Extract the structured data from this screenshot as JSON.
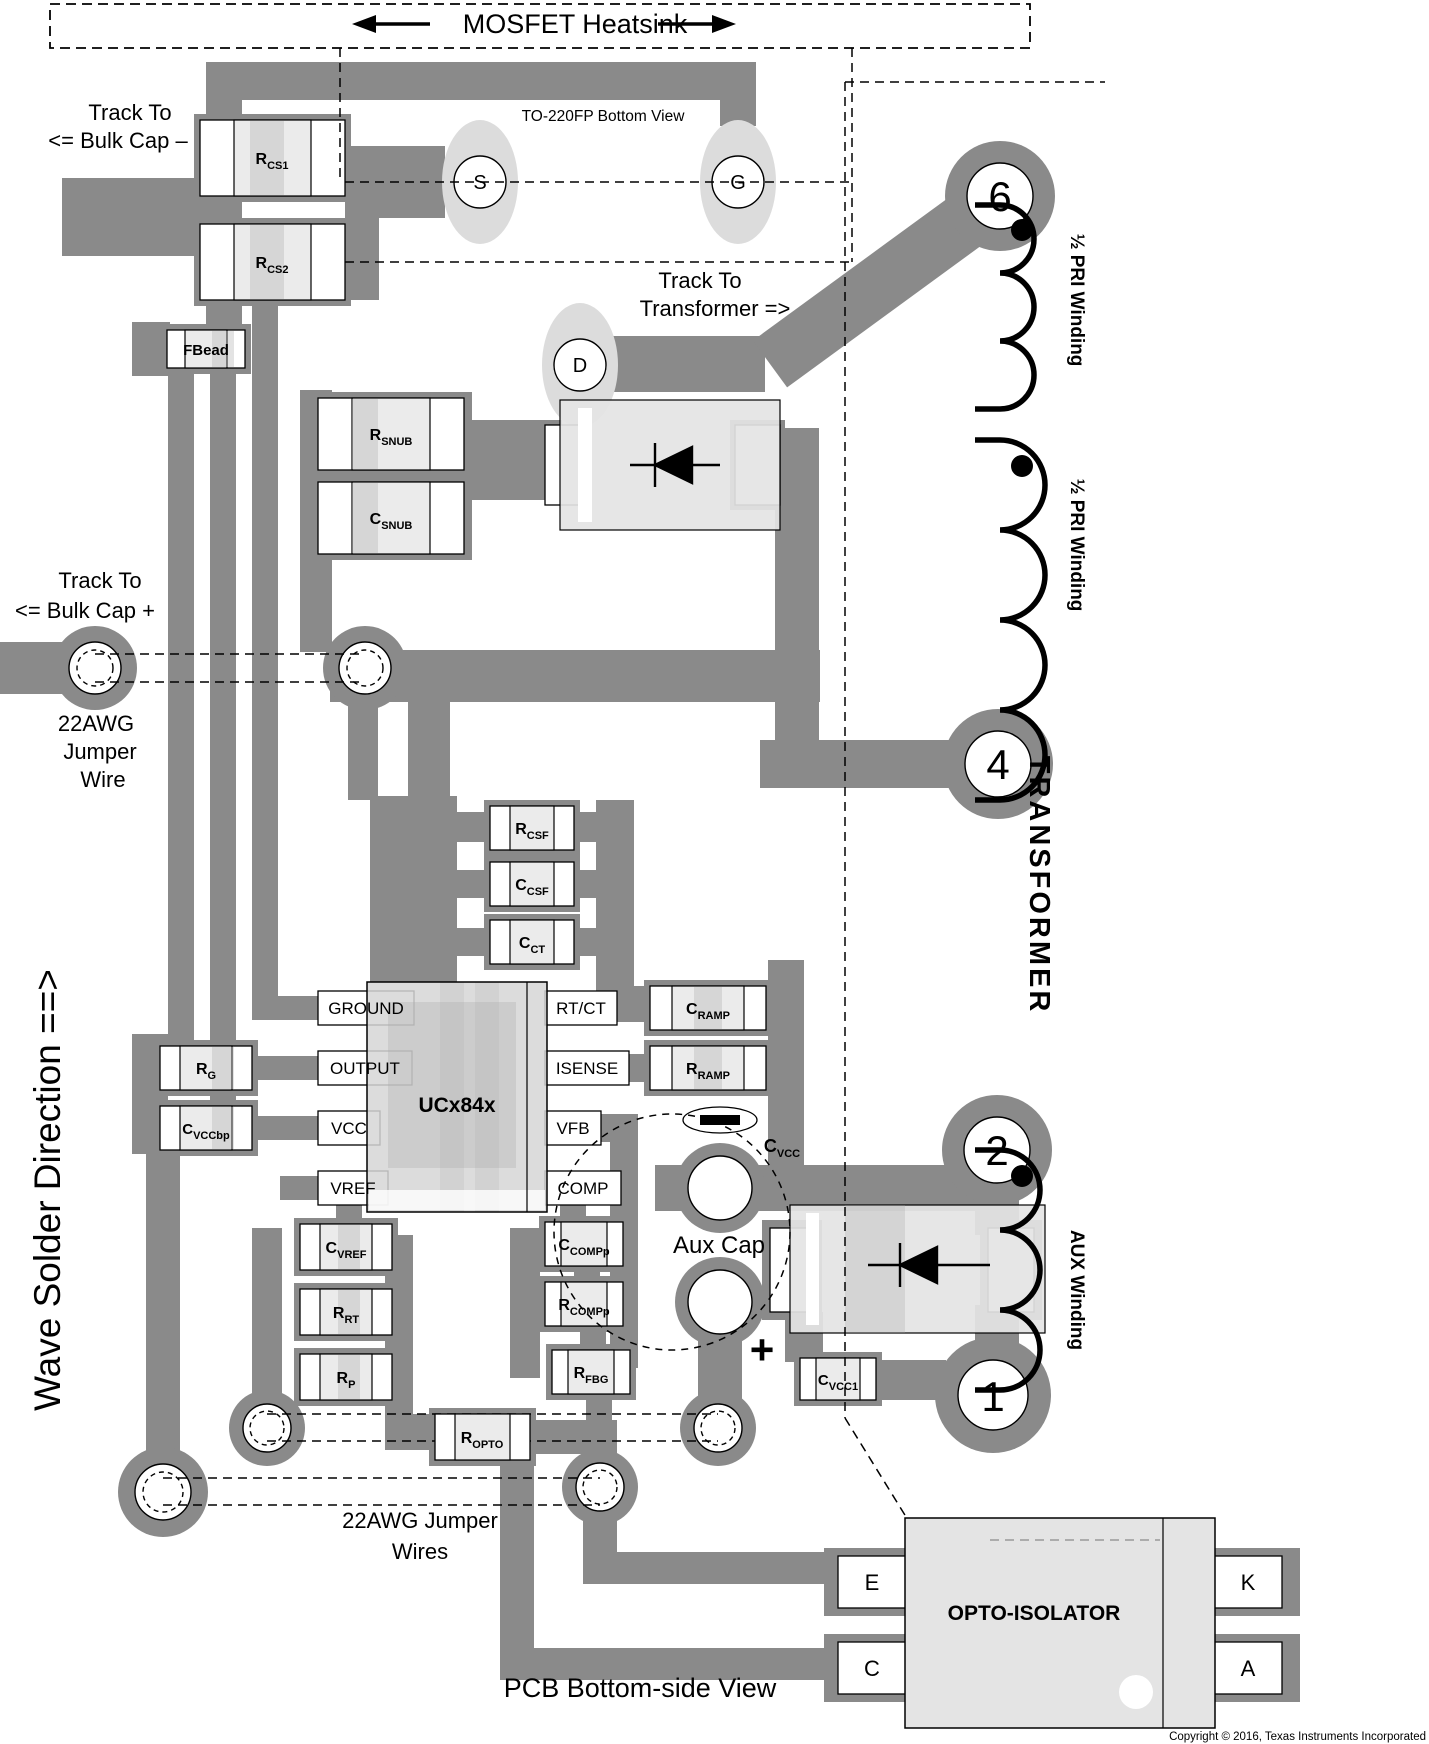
{
  "page": {
    "heatsink_label": "MOSFET Heatsink",
    "to220_label": "TO-220FP Bottom View",
    "pcb_view_label": "PCB Bottom-side View",
    "copyright": "Copyright © 2016, Texas Instruments Incorporated",
    "wave_solder_label": "Wave Solder Direction ==>",
    "transformer_label": "TRANSFORMER"
  },
  "annotations": {
    "track_to": "Track To",
    "bulk_cap_minus": "<=  Bulk Cap –",
    "transformer_arrow": "Transformer  =>",
    "bulk_cap_plus": "<=  Bulk Cap +",
    "awg22": "22AWG",
    "jumper": "Jumper",
    "wire": "Wire",
    "awg22_jumper": "22AWG Jumper",
    "wires": "Wires",
    "aux_cap": "Aux Cap",
    "plus_sign": "+",
    "half_pri_winding": "½ PRI Winding",
    "aux_winding": "AUX Winding"
  },
  "mosfet": {
    "s": "S",
    "g": "G",
    "d": "D"
  },
  "transformer_pins": {
    "p6": "6",
    "p4": "4",
    "p2": "2",
    "p1": "1"
  },
  "ic": {
    "name": "UCx84x",
    "pins": {
      "ground": "GROUND",
      "output": "OUTPUT",
      "vcc": "VCC",
      "vref": "VREF",
      "rtct": "RT/CT",
      "isense": "ISENSE",
      "vfb": "VFB",
      "comp": "COMP"
    }
  },
  "components": {
    "rcs1": {
      "main": "R",
      "sub": "CS1"
    },
    "rcs2": {
      "main": "R",
      "sub": "CS2"
    },
    "fbead": {
      "main": "FBead",
      "sub": ""
    },
    "rsnub": {
      "main": "R",
      "sub": "SNUB"
    },
    "csnub": {
      "main": "C",
      "sub": "SNUB"
    },
    "rcsf": {
      "main": "R",
      "sub": "CSF"
    },
    "ccsf": {
      "main": "C",
      "sub": "CSF"
    },
    "cct": {
      "main": "C",
      "sub": "CT"
    },
    "cramp": {
      "main": "C",
      "sub": "RAMP"
    },
    "rramp": {
      "main": "R",
      "sub": "RAMP"
    },
    "rg": {
      "main": "R",
      "sub": "G"
    },
    "cvccbp": {
      "main": "C",
      "sub": "VCCbp"
    },
    "cvref": {
      "main": "C",
      "sub": "VREF"
    },
    "rrt": {
      "main": "R",
      "sub": "RT"
    },
    "rp": {
      "main": "R",
      "sub": "P"
    },
    "ccompp": {
      "main": "C",
      "sub": "COMPp"
    },
    "rcompp": {
      "main": "R",
      "sub": "COMPp"
    },
    "rfbg": {
      "main": "R",
      "sub": "FBG"
    },
    "ropto": {
      "main": "R",
      "sub": "OPTO"
    },
    "cvcc": {
      "main": "C",
      "sub": "VCC"
    },
    "cvcc1": {
      "main": "C",
      "sub": "VCC1"
    }
  },
  "opto": {
    "name": "OPTO-ISOLATOR",
    "pin_e": "E",
    "pin_c": "C",
    "pin_k": "K",
    "pin_a": "A"
  },
  "colors": {
    "track": "#8a8a8a",
    "pad_oval": "#dcdcdc",
    "component_body": "#ececec",
    "ic_body": "#d6d6d6",
    "opto_body": "#e4e4e4"
  }
}
